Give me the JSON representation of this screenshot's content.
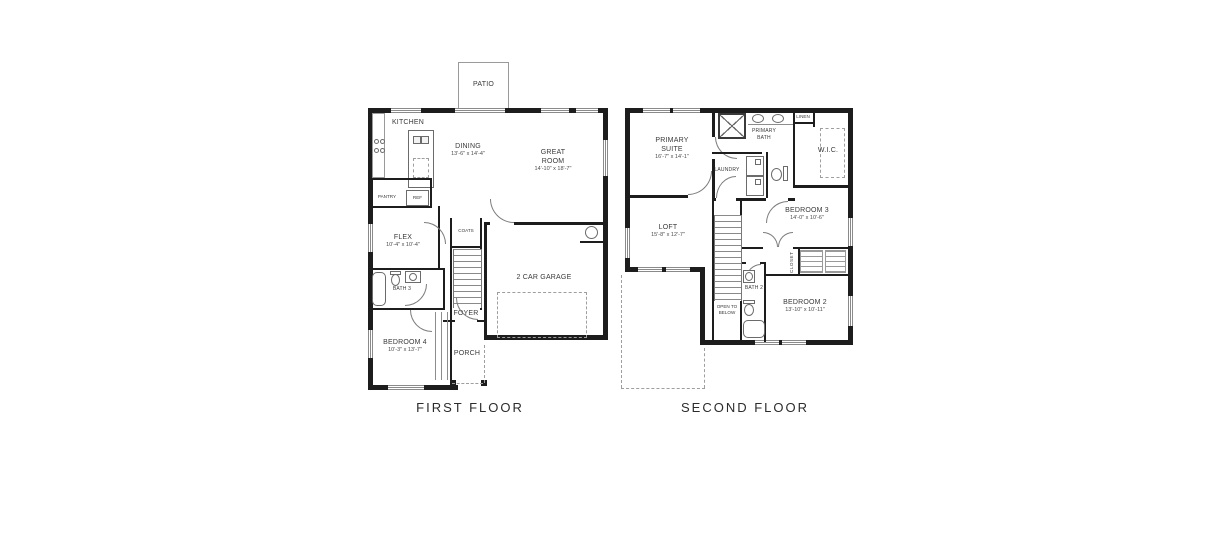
{
  "page": {
    "background": "#ffffff",
    "wall_color": "#1d1d1d"
  },
  "first_floor": {
    "label": "FIRST FLOOR",
    "rooms": {
      "patio": {
        "name": "PATIO"
      },
      "kitchen": {
        "name": "KITCHEN"
      },
      "dining": {
        "name": "DINING",
        "dims": "13'-6\" x 14'-4\""
      },
      "great_room": {
        "name": "GREAT ROOM",
        "dims": "14'-10\" x 18'-7\""
      },
      "pantry": {
        "name": "PANTRY"
      },
      "ref": {
        "name": "REF"
      },
      "flex": {
        "name": "FLEX",
        "dims": "10'-4\" x 10'-4\""
      },
      "bath3": {
        "name": "BATH 3"
      },
      "coats": {
        "name": "COATS"
      },
      "foyer": {
        "name": "FOYER"
      },
      "bedroom4": {
        "name": "BEDROOM 4",
        "dims": "10'-3\" x 13'-7\""
      },
      "porch": {
        "name": "PORCH"
      },
      "garage": {
        "name": "2 CAR GARAGE"
      }
    }
  },
  "second_floor": {
    "label": "SECOND FLOOR",
    "rooms": {
      "primary_suite": {
        "name": "PRIMARY SUITE",
        "dims": "16'-7\" x 14'-1\""
      },
      "primary_bath": {
        "name": "PRIMARY BATH"
      },
      "linen": {
        "name": "LINEN"
      },
      "wic": {
        "name": "W.I.C."
      },
      "laundry": {
        "name": "LAUNDRY"
      },
      "loft": {
        "name": "LOFT",
        "dims": "15'-8\" x 12'-7\""
      },
      "bedroom3": {
        "name": "BEDROOM 3",
        "dims": "14'-0\" x 10'-6\""
      },
      "closet": {
        "name": "CLOSET"
      },
      "bedroom2": {
        "name": "BEDROOM 2",
        "dims": "13'-10\" x 10'-11\""
      },
      "bath2": {
        "name": "BATH 2"
      },
      "open_to_below": {
        "name": "OPEN TO BELOW"
      }
    }
  }
}
